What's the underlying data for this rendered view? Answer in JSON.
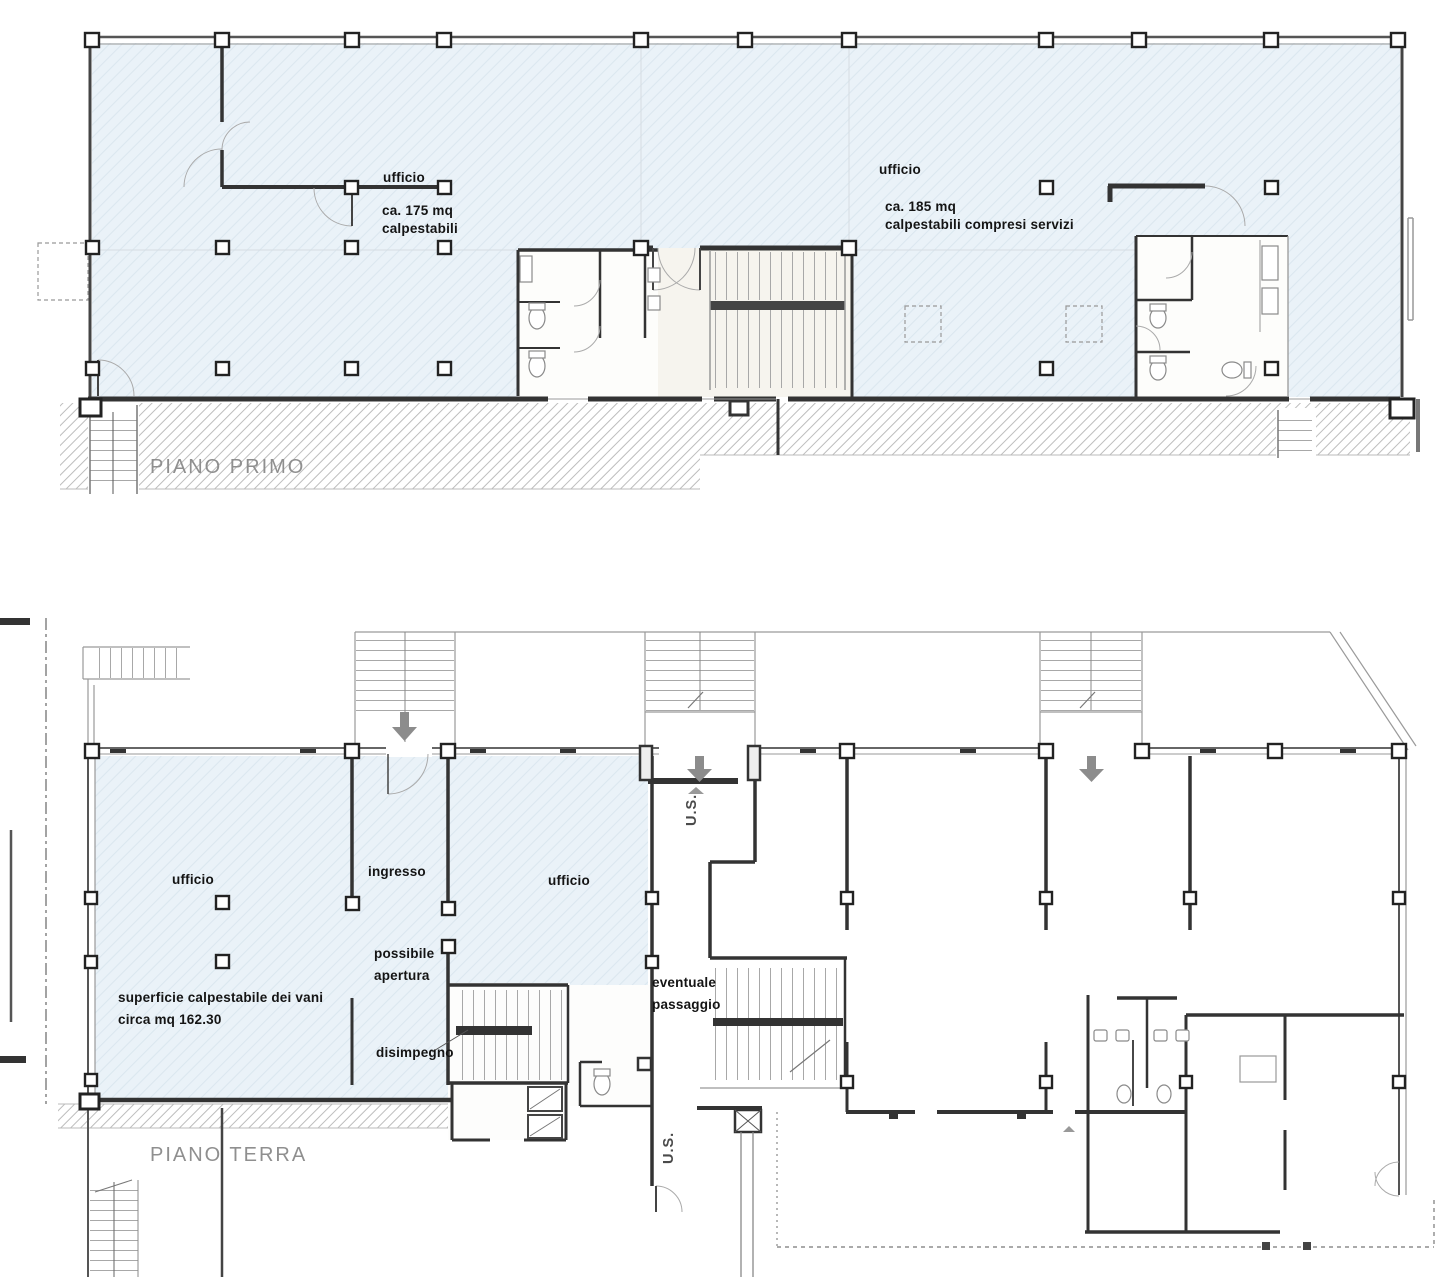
{
  "document": {
    "type": "architectural floor plan drawing",
    "language": "it"
  },
  "floors": {
    "first_floor": {
      "title": "PIANO PRIMO",
      "labels": {
        "office_left_name": "ufficio",
        "office_left_area_1": "ca. 175 mq",
        "office_left_area_2": "calpestabili",
        "office_right_name": "ufficio",
        "office_right_area_1": "ca. 185 mq",
        "office_right_area_2": "calpestabili compresi servizi"
      }
    },
    "ground_floor": {
      "title": "PIANO TERRA",
      "labels": {
        "office_left": "ufficio",
        "entrance": "ingresso",
        "office_center": "ufficio",
        "possible_opening_1": "possibile",
        "possible_opening_2": "apertura",
        "walkable_surface_1": "superficie calpestabile dei vani",
        "walkable_surface_2": "circa mq 162.30",
        "hallway": "disimpegno",
        "possible_passage_1": "eventuale",
        "possible_passage_2": "passaggio",
        "exit_upper": "U.S.",
        "exit_lower": "U.S."
      }
    }
  },
  "icons": {
    "stairs_down_arrow": "▼",
    "direction_tick": "▲",
    "door_threshold": "⊠"
  },
  "colors": {
    "background": "#ffffff",
    "room_tint": "#e9f1f7",
    "room_tint_hatch": "#d9e5ee",
    "stair_hall_tint": "#f6f4ee",
    "wall_dark": "#2f2f2f",
    "wall_medium": "#555555",
    "thin_line": "#9a9a9a",
    "ground_hatch": "#bfbfbf",
    "label_text": "#141414",
    "floor_title_text": "#8f8f8f",
    "arrow": "#8c8c8c"
  }
}
